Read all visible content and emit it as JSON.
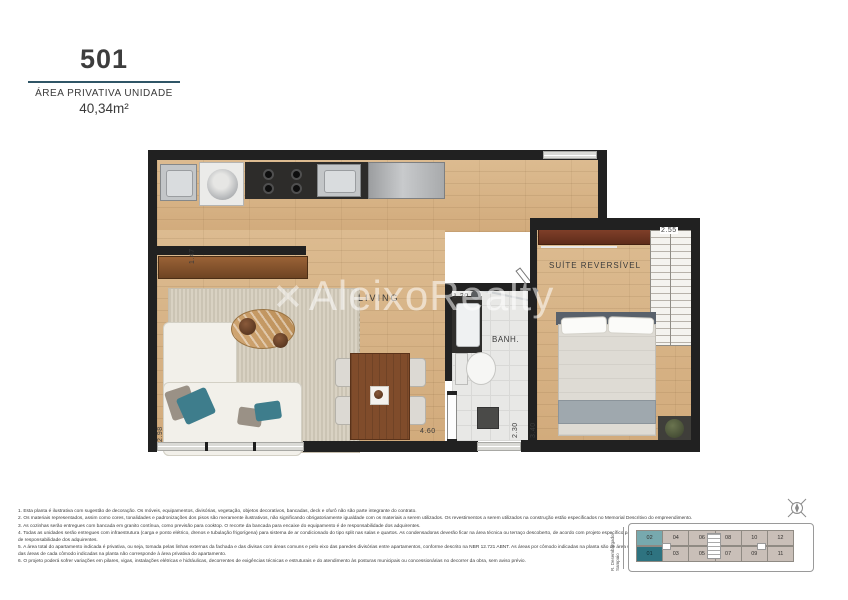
{
  "header": {
    "unit_number": "501",
    "area_label": "ÁREA PRIVATIVA UNIDADE",
    "area_value": "40,34m²",
    "accent_color": "#2f5566"
  },
  "watermark": {
    "mark": "✕",
    "text": "AleixoRealty"
  },
  "rooms": {
    "living": "LIVING",
    "suite": "SUÍTE REVERSÍVEL",
    "bathroom": "BANH."
  },
  "dimensions": {
    "kitchen_depth": "1.47",
    "suite_width": "2.55",
    "bath_width": "1.20",
    "living_length": "4.60",
    "bath_length": "2.30",
    "suite_length": "3.40",
    "living_width": "2.98"
  },
  "footnotes": [
    "1. Esta planta é ilustrativa com sugestão de decoração. Os móveis, equipamentos, divisórias, vegetação, objetos decorativos, bancadas, deck e ofurô não são parte integrante do contrato.",
    "2. Os materiais representados, assim como cores, tonalidades e padronizações dos pisos são meramente ilustrativos, não significando obrigatoriamente igualdade com os materiais a serem utilizados. Os revestimentos a serem utilizados na construção estão especificados no Memorial Descritivo do empreendimento.",
    "3. As cozinhas serão entregues com bancada em granito contínua, como previsão para cooktop. O recorte da bancada para encaixe do equipamento é de responsabilidade dos adquirentes.",
    "4. Todas as unidades serão entregues com infraestrutura (carga e ponto elétrico, drenos e tubulação frigorígena) para sistema de ar condicionado do tipo split nas salas e quartos. As condensadoras deverão ficar na área técnica ou terraço descoberto, de acordo com projeto específico para cada apartamento. A aquisição e a instalação dos equipamentos serão de responsabilidade dos adquirentes.",
    "5. A área total do apartamento indicada é privativa, ou seja, tomada pelas linhas externas da fachada e das divisas com áreas comuns e pelo eixo das paredes divisórias entre apartamentos, conforme descrito na NBR 12.721 ABNT. As áreas por cômodo indicadas na planta são de área útil, ou seja, excluindo áreas referentes às paredes. Dessa forma, a soma das áreas de cada cômodo indicadas na planta não corresponde à área privativa do apartamento.",
    "6. O projeto poderá sofrer variações em pilares, vigas, instalações elétricas e hidráulicas, decorrentes de exigências técnicas e estruturais e do atendimento às posturas municipais ou concessionárias no decorrer da obra, sem aviso prévio."
  ],
  "keyplan": {
    "street_label": "R. Desembargador Sampaio",
    "rows": {
      "top": [
        "02",
        "04",
        "06",
        "08",
        "10",
        "12"
      ],
      "bottom": [
        "01",
        "03",
        "05",
        "07",
        "09",
        "11"
      ]
    },
    "highlighted_unit": "01",
    "colors": {
      "highlight": "#2e7380",
      "secondary": "#77a9ae",
      "default": "#c9bfb8"
    }
  },
  "icons": {
    "compass": "compass-rose"
  }
}
